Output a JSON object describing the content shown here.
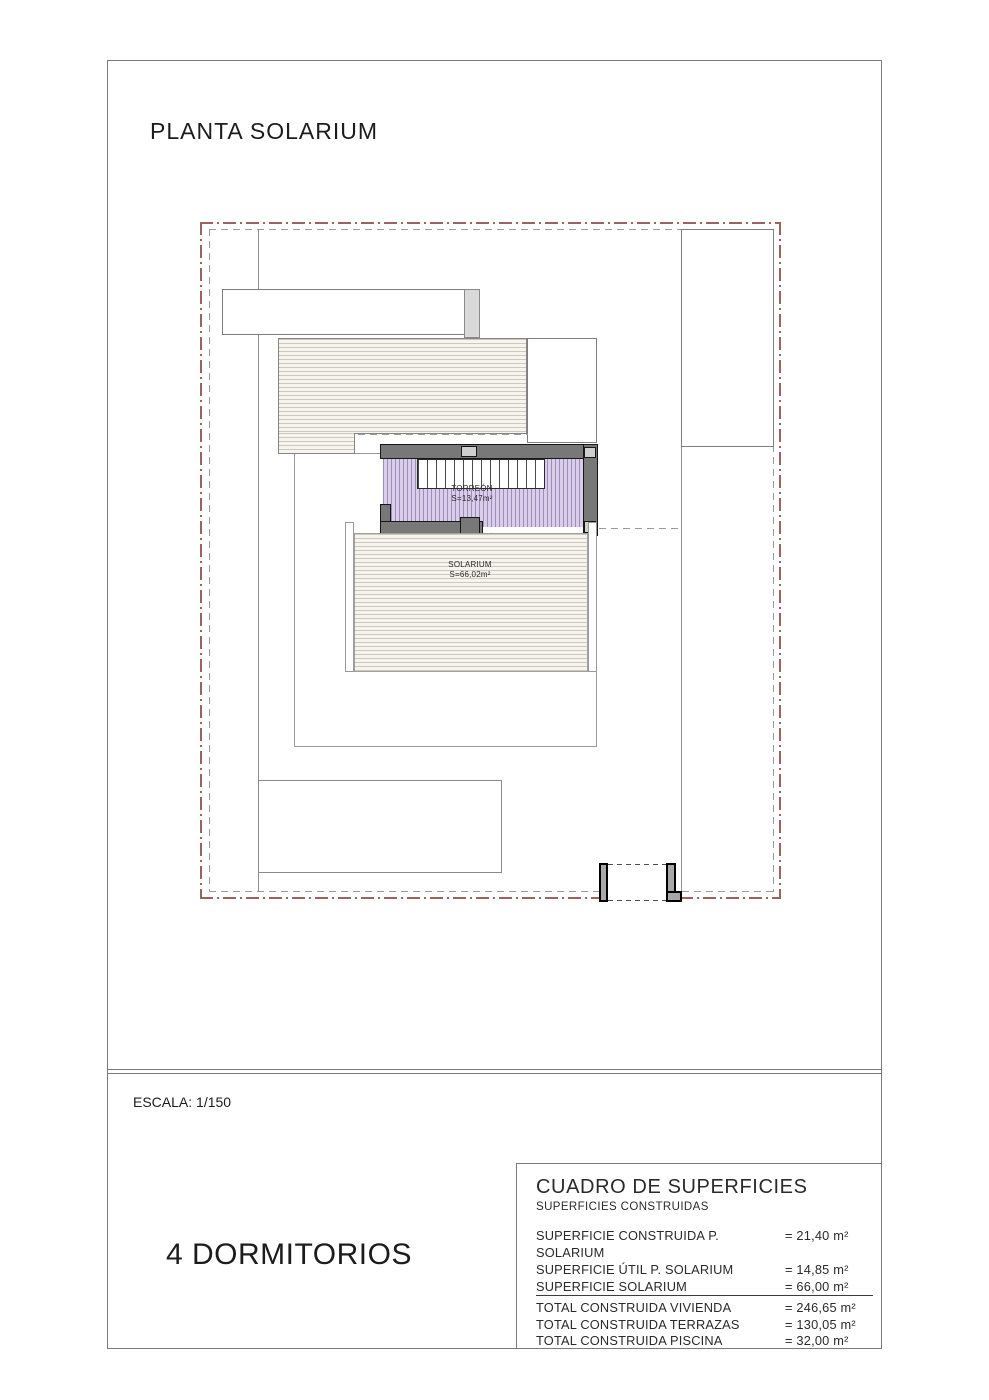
{
  "page": {
    "title": "PLANTA SOLARIUM",
    "scale": "ESCALA: 1/150",
    "bedrooms": "4 DORMITORIOS"
  },
  "plan": {
    "rooms": [
      {
        "name": "TORREÓN",
        "area": "S=13,47m²"
      },
      {
        "name": "SOLARIUM",
        "area": "S=66,02m²"
      }
    ]
  },
  "surfaces_table": {
    "title": "CUADRO DE SUPERFICIES",
    "subtitle": "SUPERFICIES CONSTRUIDAS",
    "rows": [
      {
        "label": "SUPERFICIE CONSTRUIDA P. SOLARIUM",
        "value": "= 21,40 m²"
      },
      {
        "label": "SUPERFICIE ÚTIL P. SOLARIUM",
        "value": "= 14,85 m²"
      },
      {
        "label": "SUPERFICIE SOLARIUM",
        "value": "= 66,00 m²"
      }
    ],
    "totals": [
      {
        "label": "TOTAL CONSTRUIDA VIVIENDA",
        "value": "= 246,65 m²"
      },
      {
        "label": "TOTAL CONSTRUIDA TERRAZAS",
        "value": "= 130,05 m²"
      },
      {
        "label": "TOTAL CONSTRUIDA PISCINA",
        "value": "= 32,00 m²"
      }
    ]
  },
  "colors": {
    "boundary_red": "#9c6262",
    "boundary_gray": "#9b9b9b",
    "wall_fill": "#787878",
    "wall_outline": "#161616",
    "torreon_fill": "#d9cdea",
    "torreon_hatch": "#9d8dbd",
    "terrace_hatch_bg": "#f5f4ef",
    "terrace_hatch_line": "#ccc9ba"
  }
}
